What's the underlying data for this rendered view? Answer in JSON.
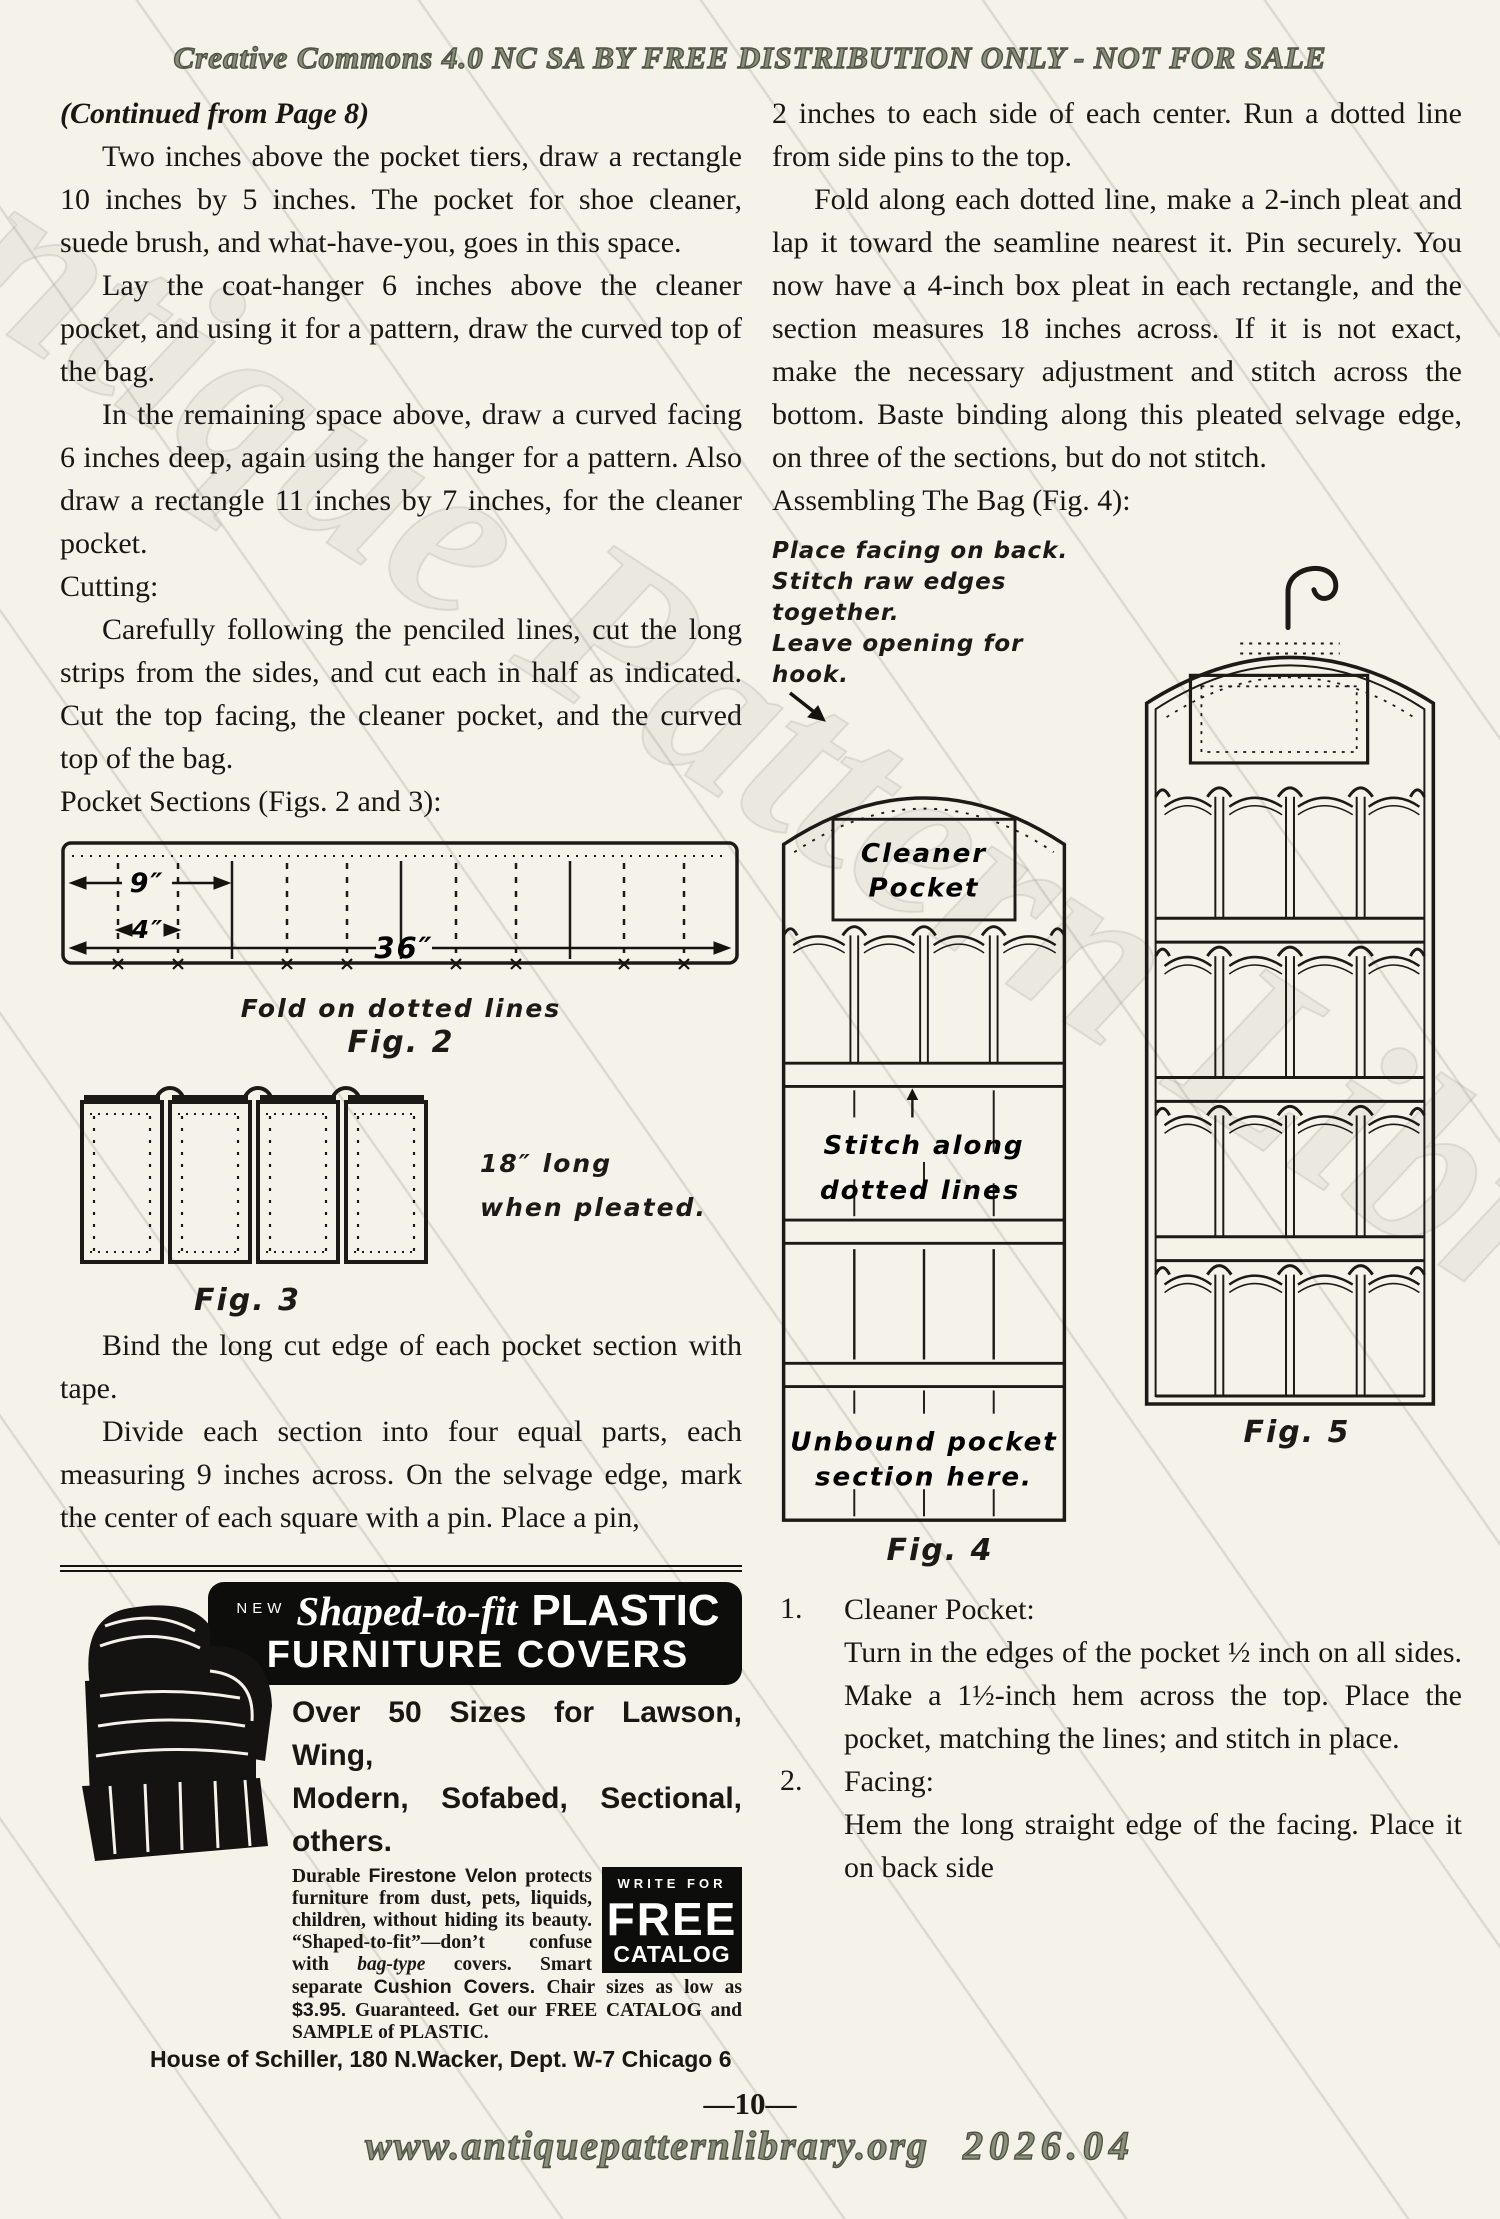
{
  "page": {
    "header": "Creative Commons 4.0 NC SA BY FREE DISTRIBUTION ONLY - NOT FOR SALE",
    "watermark": "Antique Pattern Library",
    "footer": {
      "page_number": "—10—",
      "site": "www.antiquepatternlibrary.org",
      "edition": "2026.04"
    }
  },
  "left": {
    "continued_from": "(Continued from Page 8)",
    "para_1": "Two inches above the pocket tiers, draw a rectangle 10 inches by 5 inches. The pocket for shoe cleaner, suede brush, and what-have-you, goes in this space.",
    "para_2": "Lay the coat-hanger 6 inches above the cleaner pocket, and using it for a pattern, draw the curved top of the bag.",
    "para_3": "In the remaining space above, draw a curved facing 6 inches deep, again using the hanger for a pattern. Also draw a rectangle 11 inches by 7 inches, for the cleaner pocket.",
    "heading_cutting": "Cutting:",
    "para_4": "Carefully following the penciled lines, cut the long strips from the sides, and cut each in half as indicated. Cut the top facing, the cleaner pocket, and the curved top of the bag.",
    "heading_pocket_sections": "Pocket Sections (Figs. 2 and 3):",
    "para_5": "Bind the long cut edge of each pocket section with tape.",
    "para_6": "Divide each section into four equal parts, each measuring 9 inches across. On the selvage edge, mark the center of each square with a pin.  Place a pin,"
  },
  "fig2": {
    "dim_section": "9″",
    "dim_pleat": "4″",
    "dim_total": "36″",
    "note": "Fold on dotted lines",
    "label": "Fig. 2"
  },
  "fig3": {
    "note_line1": "18″ long",
    "note_line2": "when pleated.",
    "label": "Fig. 3"
  },
  "fig4": {
    "annotation_line1": "Place facing on back.",
    "annotation_line2": "Stitch raw edges together.",
    "annotation_line3": "Leave opening for hook.",
    "cleaner_pocket_line1": "Cleaner",
    "cleaner_pocket_line2": "Pocket",
    "stitch_line1": "Stitch along",
    "stitch_line2": "dotted lines",
    "unbound_line1": "Unbound pocket",
    "unbound_line2": "section here.",
    "label": "Fig. 4"
  },
  "fig5": {
    "label": "Fig. 5"
  },
  "right": {
    "para_1": "2 inches to each side of each center. Run a dotted line from side pins to the top.",
    "para_2": "Fold along each dotted line, make a 2-inch pleat and lap it toward the seamline nearest it.  Pin securely.  You now have a 4-inch box pleat in each rectangle, and the section measures 18 inches across.  If it is not exact, make the necessary adjustment and stitch across the bottom.  Baste binding along this pleated selvage edge, on three of the sections, but do not stitch.",
    "heading_assembling": "Assembling The Bag (Fig. 4):",
    "list": [
      {
        "num": "1.",
        "title": "Cleaner Pocket:",
        "body": "Turn in the edges of the pocket ½ inch on all sides.  Make a 1½-inch hem across the top. Place the pocket, matching the lines; and stitch in place."
      },
      {
        "num": "2.",
        "title": "Facing:",
        "body": "Hem the long straight edge of the facing.  Place it on back side"
      }
    ]
  },
  "ad": {
    "new_label": "NEW",
    "script_word": "Shaped-to-fit",
    "product_word": "PLASTIC",
    "title_line2": "FURNITURE COVERS",
    "sizes_line1": "Over 50 Sizes for Lawson, Wing,",
    "sizes_line2": "Modern, Sofabed, Sectional, others.",
    "body_seg1": "Durable ",
    "body_seg2": "Firestone Velon",
    "body_seg3": " protects furniture from dust, pets, liquids, children, without hiding its beauty. “Shaped-to-fit”—don’t confuse with ",
    "body_seg4": "bag-type",
    "body_seg5": " covers.  Smart separate ",
    "body_seg6": "Cushion Covers.",
    "body_seg7": " Chair sizes as low as ",
    "body_seg8": "$3.95.",
    "body_seg9": " Guaranteed. Get our FREE CATALOG and SAMPLE of PLASTIC.",
    "box_write_for": "WRITE FOR",
    "box_free": "FREE",
    "box_catalog": "CATALOG",
    "address": "House of Schiller, 180 N.Wacker, Dept. W-7 Chicago 6"
  }
}
